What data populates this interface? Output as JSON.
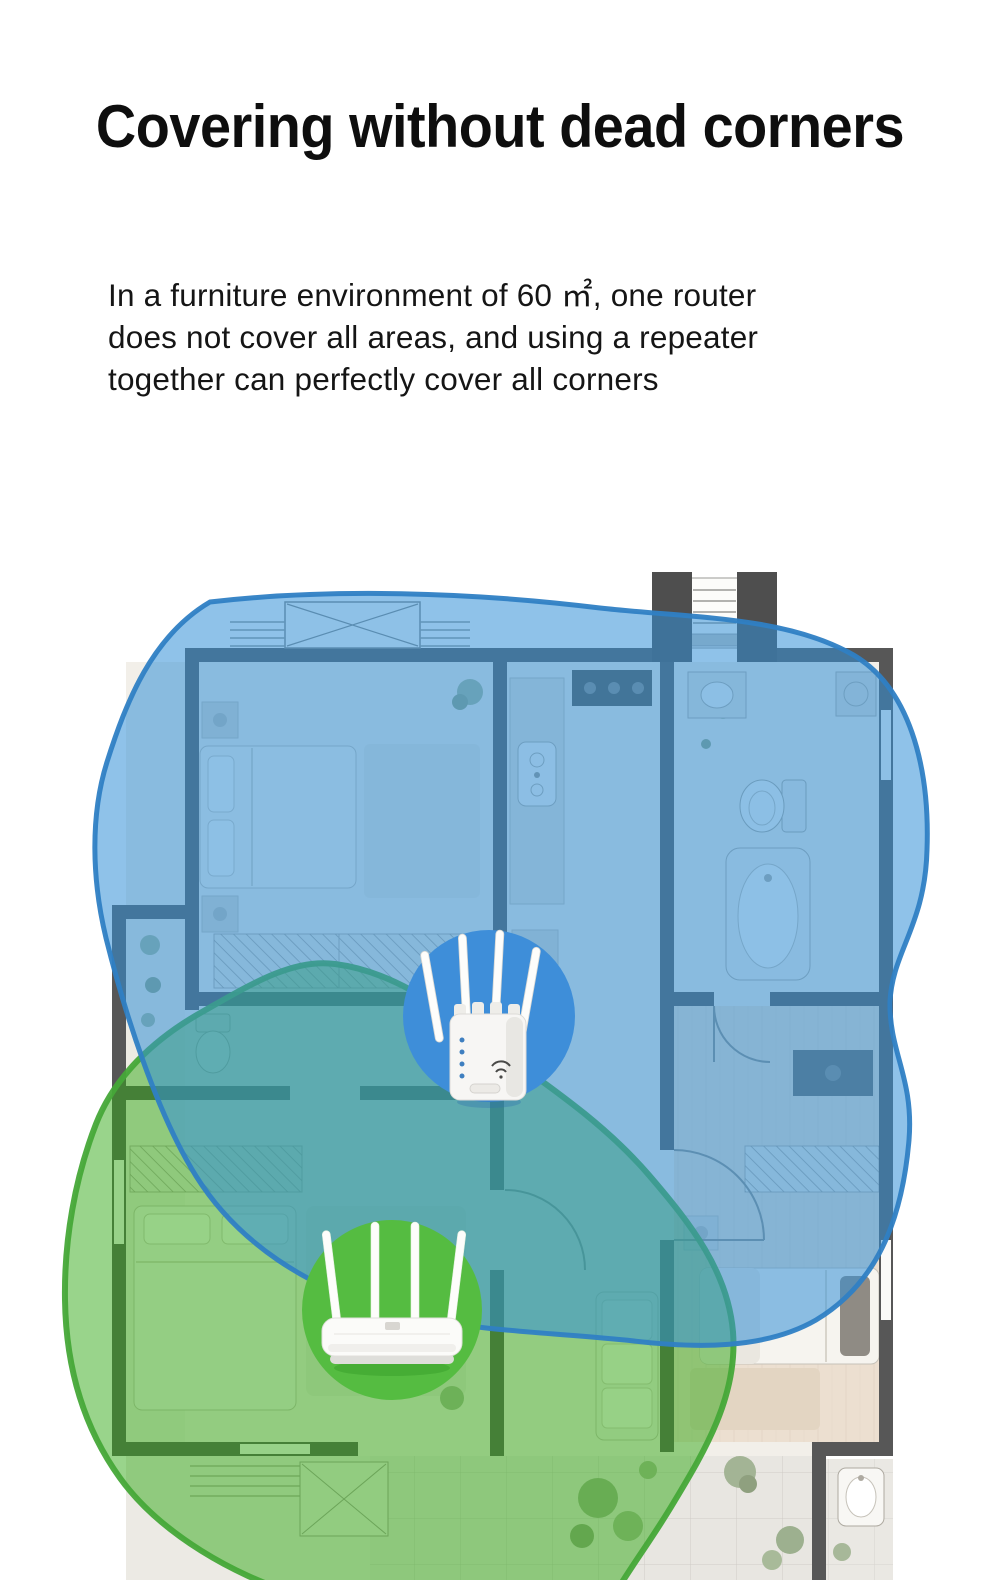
{
  "title": "Covering without dead corners",
  "description_lines": [
    "In a furniture environment of 60 ㎡, one router",
    "does not cover all areas, and using a repeater",
    "together can perfectly cover all corners"
  ],
  "icons": {
    "repeater": "wifi-repeater-icon",
    "router": "router-icon"
  },
  "colors": {
    "repeater_zone_fill": "#3390d7",
    "repeater_zone_border": "#2f7fc4",
    "router_zone_fill": "#33aa18",
    "router_zone_border": "#46a838",
    "repeater_badge": "#3e8ed9",
    "router_badge": "#55bc41",
    "wall": "#575757"
  }
}
